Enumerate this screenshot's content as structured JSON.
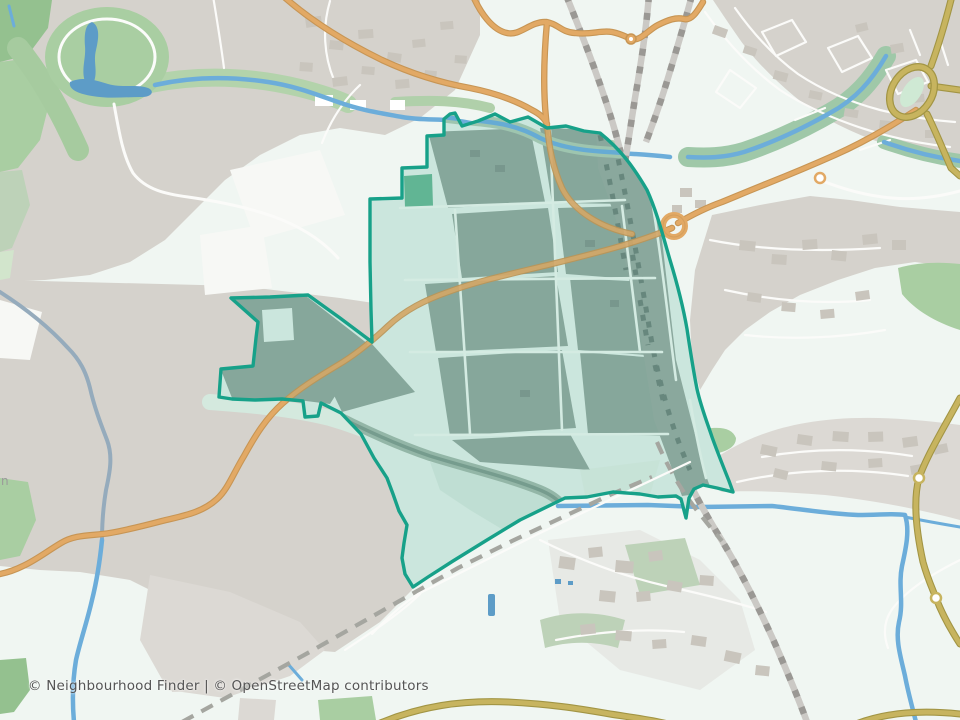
{
  "map": {
    "attribution": {
      "text": "© Neighbourhood Finder | © OpenStreetMap contributors"
    },
    "clipped_place_label": "n",
    "highlighted_area": {
      "name": "neighbourhood-boundary",
      "outline_color": "#17a189",
      "fill_tint": "rgba(23,161,137,0.12)"
    },
    "features": {
      "park": "park-with-lake",
      "railway": "railway-junction-lines",
      "secondary_roads": "orange-roads",
      "trunk_road": "olive-road-with-roundabouts",
      "water": "rivers-streams-canal"
    }
  },
  "palette": {
    "base": "#f0f6f2",
    "land-gray": "#d5d2cc",
    "land-gray2": "#dcd9d4",
    "field-white": "#f7f8f5",
    "building": "#c9c5bd",
    "building-dark": "#bdb9b0",
    "green": "#a9cea2",
    "green-dark": "#94c18f",
    "green-gray": "#bdd2b8",
    "green-pale": "#d2e5cc",
    "water": "#6cadda",
    "water-dark": "#5d9cc7",
    "water-muted": "#95abbc",
    "road-orange": "#e2a965",
    "road-orange-casing": "#c79554",
    "road-olive": "#c7b45f",
    "road-olive-casing": "#a29544",
    "rail-base": "#cbc9c5",
    "rail-dash": "#9a9894",
    "rail-dash2": "#a5a6a0",
    "street-white": "#fbfbf9",
    "boundary": "#17a189",
    "inside-mint": "#d9ece3",
    "inside-sage": "#8fa89d",
    "inside-sage-dark": "#7f978d",
    "inside-corridor": "#93a99f",
    "inside-tick": "#6d867c",
    "inside-street": "#e2f1e9",
    "inside-green": "#67b795",
    "inside-stream": "#7d9c8e",
    "inside-band": "#9db8a9",
    "attribution-color": "#545454",
    "label-gray": "#9a9a9a"
  }
}
